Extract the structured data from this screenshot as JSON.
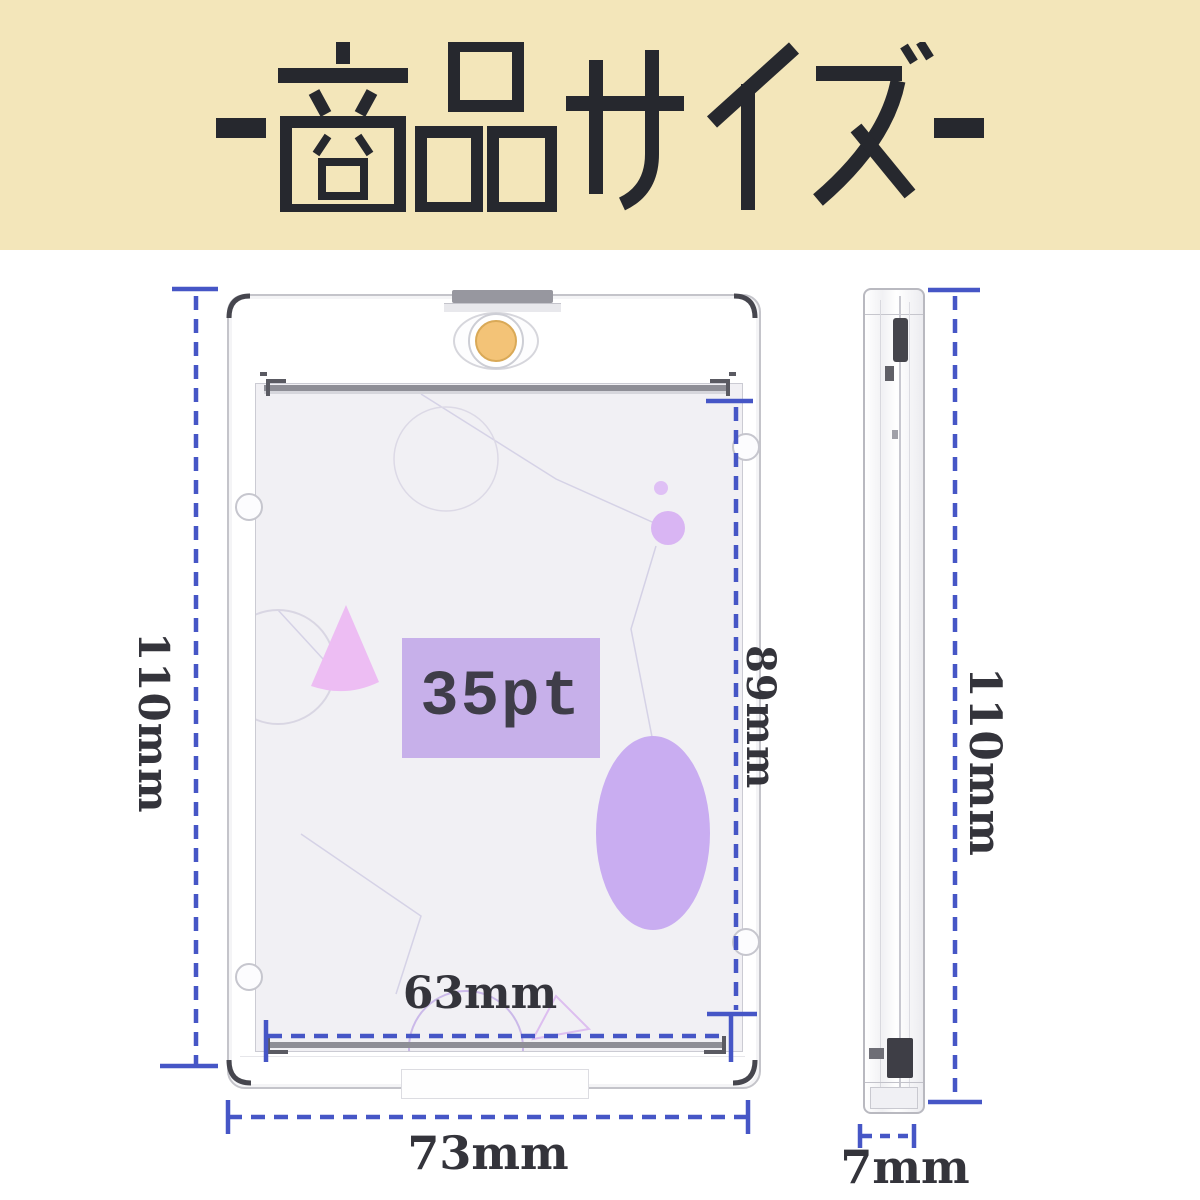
{
  "banner": {
    "title": "-商品サイズ-",
    "bg_color": "#f3e6ba",
    "text_color": "#26282e"
  },
  "front_view": {
    "card_capacity_label": "35pt"
  },
  "dimensions": {
    "front_outer_height": "110mm",
    "front_inner_height": "89mm",
    "front_inner_width": "63mm",
    "front_outer_width": "73mm",
    "side_height": "110mm",
    "side_thickness": "7mm"
  },
  "colors": {
    "dimension_blue": "#4656c6",
    "accent_gold": "#f3c377",
    "purple_fill": "#c9adf1",
    "badge_purple": "#c7b0ea"
  }
}
